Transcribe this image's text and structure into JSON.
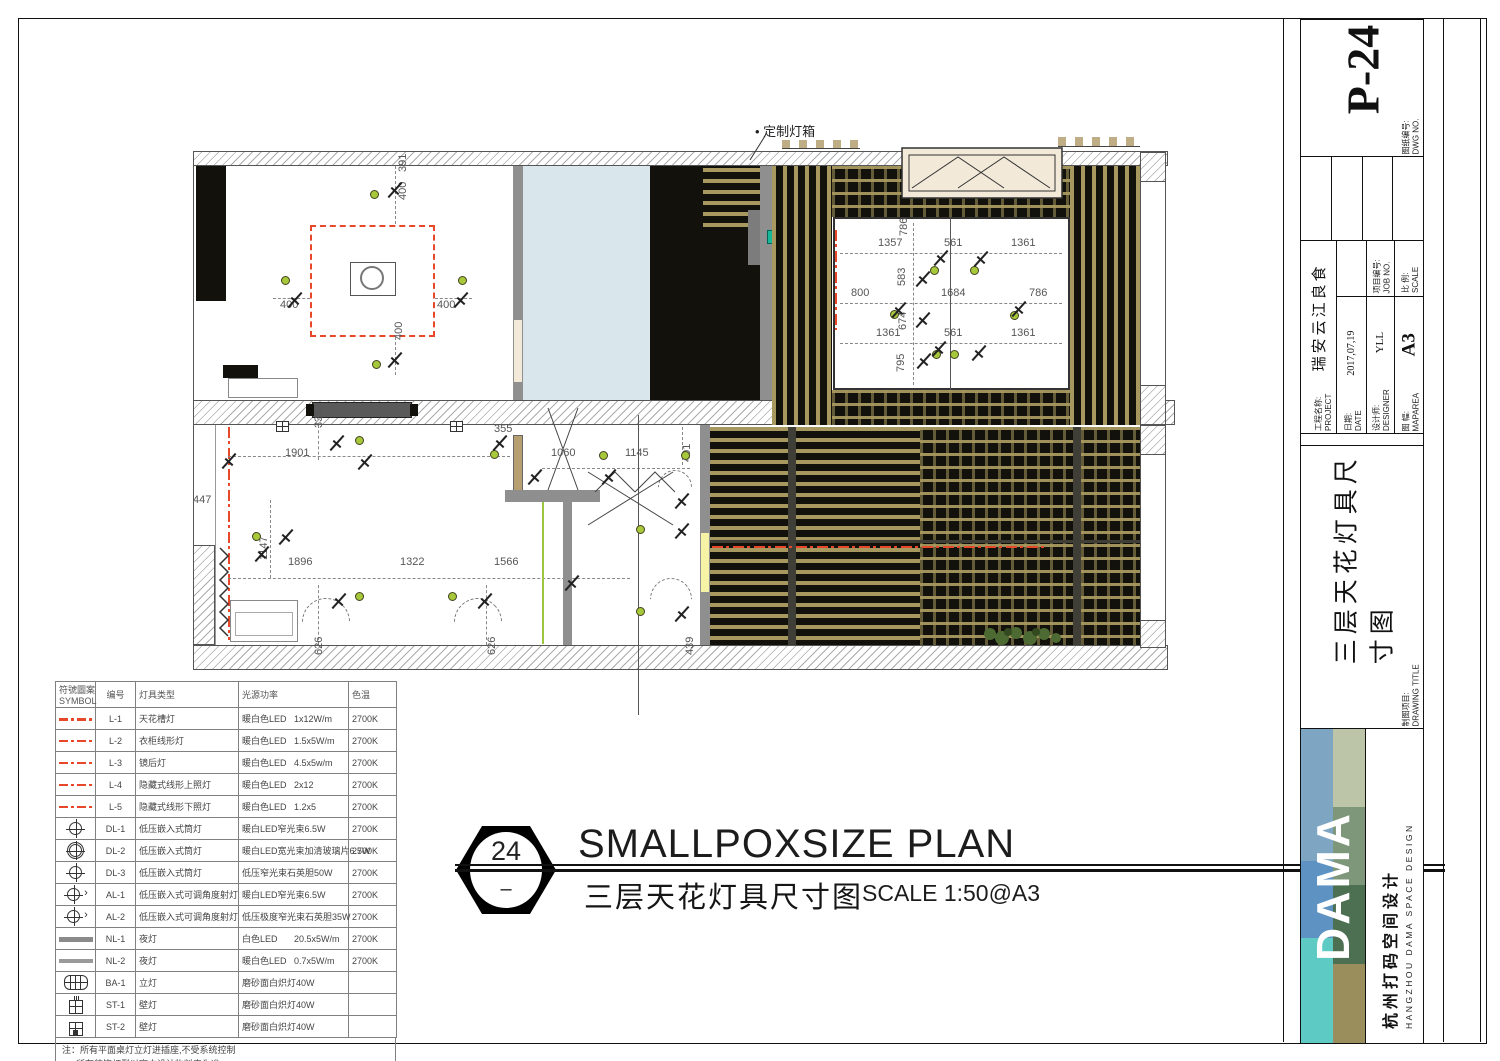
{
  "colors": {
    "accent_red": "#e8482a",
    "slat_tan": "#a7985f",
    "black_bg": "#12110b",
    "blue_room": "#d9e7ec",
    "gray_wall": "#8f8f8f",
    "beige_door": "#b89f72",
    "cream_box": "#f2e9d8",
    "yellow_strip": "#f6f2a6",
    "green_line": "#9bc63e",
    "dot_green": "#a8c83c",
    "teal_marker": "#19b79a",
    "logo_blue1": "#7ea6c3",
    "logo_blue2": "#5e92c2",
    "logo_teal": "#5ecac4",
    "logo_sage": "#bcc5a7",
    "logo_green1": "#7e977a",
    "logo_green2": "#4d7053",
    "logo_olive": "#9a8e5d"
  },
  "plan": {
    "lightbox_label": "• 定制灯箱",
    "dimensions": [
      {
        "x": 208,
        "y": 32,
        "t": "391",
        "v": 1
      },
      {
        "x": 208,
        "y": 60,
        "t": "400",
        "v": 1
      },
      {
        "x": 90,
        "y": 160,
        "t": "400"
      },
      {
        "x": 247,
        "y": 160,
        "t": "400"
      },
      {
        "x": 204,
        "y": 200,
        "t": "400",
        "v": 1
      },
      {
        "x": 688,
        "y": 98,
        "t": "1357"
      },
      {
        "x": 709,
        "y": 96,
        "t": "786",
        "v": 1
      },
      {
        "x": 754,
        "y": 98,
        "t": "561"
      },
      {
        "x": 821,
        "y": 98,
        "t": "1361"
      },
      {
        "x": 661,
        "y": 148,
        "t": "800"
      },
      {
        "x": 707,
        "y": 146,
        "t": "583",
        "v": 1
      },
      {
        "x": 751,
        "y": 148,
        "t": "1684"
      },
      {
        "x": 839,
        "y": 148,
        "t": "786"
      },
      {
        "x": 686,
        "y": 188,
        "t": "1361"
      },
      {
        "x": 708,
        "y": 190,
        "t": "674",
        "v": 1
      },
      {
        "x": 754,
        "y": 188,
        "t": "561"
      },
      {
        "x": 821,
        "y": 188,
        "t": "1361"
      },
      {
        "x": 706,
        "y": 232,
        "t": "795",
        "v": 1
      },
      {
        "x": 3,
        "y": 355,
        "t": "447"
      },
      {
        "x": 124,
        "y": 288,
        "t": "335",
        "v": 1
      },
      {
        "x": 95,
        "y": 308,
        "t": "1901"
      },
      {
        "x": 304,
        "y": 284,
        "t": "355"
      },
      {
        "x": 69,
        "y": 420,
        "t": "1147",
        "v": 1
      },
      {
        "x": 98,
        "y": 417,
        "t": "1896"
      },
      {
        "x": 210,
        "y": 417,
        "t": "1322"
      },
      {
        "x": 304,
        "y": 417,
        "t": "1566"
      },
      {
        "x": 124,
        "y": 515,
        "t": "626",
        "v": 1
      },
      {
        "x": 297,
        "y": 515,
        "t": "626",
        "v": 1
      },
      {
        "x": 361,
        "y": 308,
        "t": "1060"
      },
      {
        "x": 435,
        "y": 308,
        "t": "1145"
      },
      {
        "x": 492,
        "y": 322,
        "t": "401",
        "v": 1
      },
      {
        "x": 495,
        "y": 515,
        "t": "439",
        "v": 1
      }
    ],
    "fixtures": [
      {
        "k": "dot",
        "x": 180,
        "y": 50
      },
      {
        "k": "dot",
        "x": 91,
        "y": 136
      },
      {
        "k": "dot",
        "x": 268,
        "y": 136
      },
      {
        "k": "dot",
        "x": 182,
        "y": 220
      },
      {
        "k": "dot",
        "x": 740,
        "y": 126
      },
      {
        "k": "dot",
        "x": 780,
        "y": 126
      },
      {
        "k": "dot",
        "x": 700,
        "y": 170
      },
      {
        "k": "dot",
        "x": 820,
        "y": 171
      },
      {
        "k": "dot",
        "x": 742,
        "y": 210
      },
      {
        "k": "dot",
        "x": 760,
        "y": 210
      },
      {
        "k": "dot",
        "x": 165,
        "y": 296
      },
      {
        "k": "dot",
        "x": 300,
        "y": 310
      },
      {
        "k": "dot",
        "x": 62,
        "y": 392
      },
      {
        "k": "dot",
        "x": 165,
        "y": 452
      },
      {
        "k": "dot",
        "x": 258,
        "y": 452
      },
      {
        "k": "dot",
        "x": 409,
        "y": 311
      },
      {
        "k": "dot",
        "x": 491,
        "y": 311
      },
      {
        "k": "dot",
        "x": 446,
        "y": 385
      },
      {
        "k": "dot",
        "x": 446,
        "y": 467
      },
      {
        "k": "spot",
        "x": 196,
        "y": 42
      },
      {
        "k": "spot",
        "x": 96,
        "y": 152
      },
      {
        "k": "spot",
        "x": 262,
        "y": 152
      },
      {
        "k": "spot",
        "x": 196,
        "y": 212
      },
      {
        "k": "spot",
        "x": 742,
        "y": 110
      },
      {
        "k": "spot",
        "x": 782,
        "y": 111
      },
      {
        "k": "spot",
        "x": 724,
        "y": 131
      },
      {
        "k": "spot",
        "x": 700,
        "y": 162
      },
      {
        "k": "spot",
        "x": 820,
        "y": 161
      },
      {
        "k": "spot",
        "x": 724,
        "y": 172
      },
      {
        "k": "spot",
        "x": 740,
        "y": 201
      },
      {
        "k": "spot",
        "x": 780,
        "y": 205
      },
      {
        "k": "spot",
        "x": 725,
        "y": 213
      },
      {
        "k": "spot",
        "x": 30,
        "y": 313
      },
      {
        "k": "spot",
        "x": 138,
        "y": 295
      },
      {
        "k": "spot",
        "x": 166,
        "y": 314
      },
      {
        "k": "spot",
        "x": 63,
        "y": 406
      },
      {
        "k": "spot",
        "x": 87,
        "y": 389
      },
      {
        "k": "spot",
        "x": 140,
        "y": 453
      },
      {
        "k": "spot",
        "x": 286,
        "y": 453
      },
      {
        "k": "spot",
        "x": 301,
        "y": 295
      },
      {
        "k": "spot",
        "x": 336,
        "y": 329
      },
      {
        "k": "spot",
        "x": 410,
        "y": 329
      },
      {
        "k": "spot",
        "x": 483,
        "y": 353
      },
      {
        "k": "spot",
        "x": 483,
        "y": 383
      },
      {
        "k": "spot",
        "x": 483,
        "y": 466
      },
      {
        "k": "spot",
        "x": 373,
        "y": 435
      },
      {
        "k": "wl",
        "x": 86,
        "y": 281
      },
      {
        "k": "wl",
        "x": 260,
        "y": 281
      }
    ]
  },
  "legend": {
    "headers": {
      "symbol_cn": "符號圖案",
      "symbol_en": "SYMBOL",
      "code": "编号",
      "type": "灯具类型",
      "source": "光源",
      "power": "功率",
      "temp": "色温"
    },
    "rows": [
      {
        "sym": "lred",
        "code": "L-1",
        "type": "天花槽灯",
        "src": "暖白色LED",
        "pow": "1x12W/m",
        "temp": "2700K"
      },
      {
        "sym": "lred thin",
        "code": "L-2",
        "type": "衣柜线形灯",
        "src": "暖白色LED",
        "pow": "1.5x5W/m",
        "temp": "2700K"
      },
      {
        "sym": "lred thin",
        "code": "L-3",
        "type": "镜后灯",
        "src": "暖白色LED",
        "pow": "4.5x5w/m",
        "temp": "2700K"
      },
      {
        "sym": "lred thin",
        "code": "L-4",
        "type": "隐藏式线形上照灯",
        "src": "暖白色LED",
        "pow": "2x12",
        "temp": "2700K"
      },
      {
        "sym": "lred thin",
        "code": "L-5",
        "type": "隐藏式线形下照灯",
        "src": "暖白色LED",
        "pow": "1.2x5",
        "temp": "2700K"
      },
      {
        "sym": "dl",
        "code": "DL-1",
        "type": "低压嵌入式筒灯",
        "src": "暖白LED窄光束",
        "pow": "6.5W",
        "temp": "2700K"
      },
      {
        "sym": "dl boxed",
        "code": "DL-2",
        "type": "低压嵌入式筒灯",
        "src": "暖白LED宽光束加清玻璃片",
        "pow": "6.5W",
        "temp": "2700K"
      },
      {
        "sym": "dl",
        "code": "DL-3",
        "type": "低压嵌入式筒灯",
        "src": "低压窄光束石英胆",
        "pow": "50W",
        "temp": "2700K"
      },
      {
        "sym": "dl al",
        "code": "AL-1",
        "type": "低压嵌入式可调角度射灯",
        "src": "暖白LED窄光束",
        "pow": "6.5W",
        "temp": "2700K"
      },
      {
        "sym": "dl al",
        "code": "AL-2",
        "type": "低压嵌入式可调角度射灯",
        "src": "低压极度窄光束石英胆",
        "pow": "35W",
        "temp": "2700K"
      },
      {
        "sym": "nl1",
        "code": "NL-1",
        "type": "夜灯",
        "src": "白色LED",
        "pow": "20.5x5W/m",
        "temp": "2700K"
      },
      {
        "sym": "nl2",
        "code": "NL-2",
        "type": "夜灯",
        "src": "暖白色LED",
        "pow": "0.7x5W/m",
        "temp": "2700K"
      },
      {
        "sym": "ba",
        "code": "BA-1",
        "type": "立灯",
        "src": "磨砂面白炽灯",
        "pow": "40W",
        "temp": ""
      },
      {
        "sym": "st1",
        "code": "ST-1",
        "type": "壁灯",
        "src": "磨砂面白炽灯",
        "pow": "40W",
        "temp": ""
      },
      {
        "sym": "st2",
        "code": "ST-2",
        "type": "壁灯",
        "src": "磨砂面白炽灯",
        "pow": "40W",
        "temp": ""
      }
    ],
    "note1": "注：所有平面桌灯立灯进插座,不受系统控制",
    "note2": "所有装饰灯型以室内设计物料表为准"
  },
  "titlemark": {
    "number": "24",
    "dash": "–",
    "title_en": "SMALLPOXSIZE PLAN",
    "title_cn": "三层天花灯具尺寸图",
    "scale": "SCALE 1:50@A3"
  },
  "titleblock": {
    "dwg_label_cn": "图纸编号:",
    "dwg_label_en": "DWG NO.",
    "dwg_no": "P-24",
    "project_label_cn": "工程名称:",
    "project_label_en": "PROJECT",
    "project": "瑞安云江良食",
    "date_label_cn": "日期:",
    "date_label_en": "DATE",
    "date": "2017,07,19",
    "designer_label_cn": "设计师:",
    "designer_label_en": "DESIGNER",
    "designer": "YLL",
    "maparea_label_cn": "图 幅:",
    "maparea_label_en": "MAPAREA",
    "maparea": "A3",
    "jobno_label_cn": "项目编号:",
    "jobno_label_en": "JOB NO.",
    "scale_label_cn": "比 例:",
    "scale_label_en": "SCALE",
    "drawing_label_cn": "制图项目:",
    "drawing_label_en": "DRAWING TITLE",
    "drawing_title": "三层天花灯具尺寸图",
    "logo_text": "DAMA",
    "company_cn": "杭州打码空间设计",
    "company_en": "HANGZHOU DAMA SPACE DESIGN"
  }
}
